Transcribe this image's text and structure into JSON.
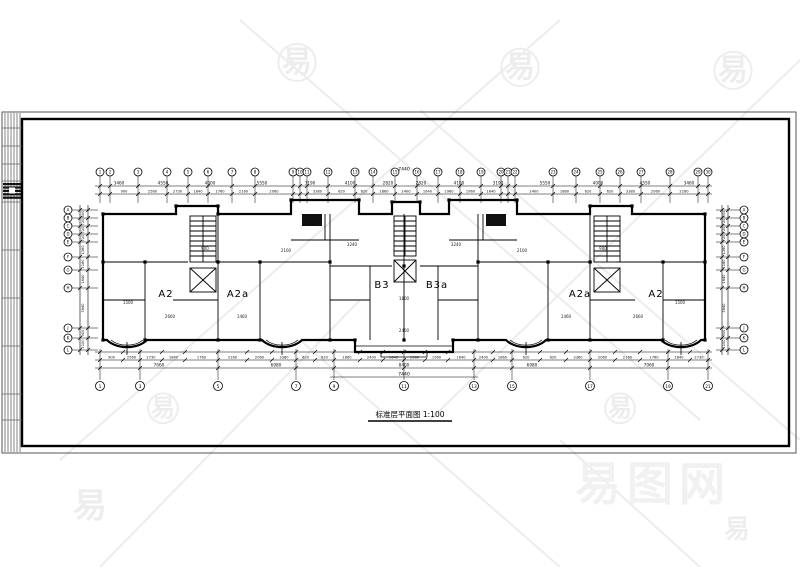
{
  "plan": {
    "title_line": "标准层平面图 1:100",
    "units": [
      {
        "label": "A2",
        "x": 166,
        "y": 297
      },
      {
        "label": "A2a",
        "x": 238,
        "y": 297
      },
      {
        "label": "B3",
        "x": 382,
        "y": 288
      },
      {
        "label": "B3a",
        "x": 437,
        "y": 288
      },
      {
        "label": "A2a",
        "x": 580,
        "y": 297
      },
      {
        "label": "A2",
        "x": 656,
        "y": 297
      }
    ],
    "annotations": [
      {
        "t": "1500",
        "x": 128,
        "y": 304
      },
      {
        "t": "2660",
        "x": 170,
        "y": 318
      },
      {
        "t": "900",
        "x": 205,
        "y": 250
      },
      {
        "t": "1460",
        "x": 242,
        "y": 318
      },
      {
        "t": "2100",
        "x": 286,
        "y": 252
      },
      {
        "t": "3240",
        "x": 352,
        "y": 246
      },
      {
        "t": "1800",
        "x": 404,
        "y": 300
      },
      {
        "t": "3240",
        "x": 456,
        "y": 246
      },
      {
        "t": "2100",
        "x": 522,
        "y": 252
      },
      {
        "t": "1460",
        "x": 566,
        "y": 318
      },
      {
        "t": "900",
        "x": 603,
        "y": 250
      },
      {
        "t": "2660",
        "x": 638,
        "y": 318
      },
      {
        "t": "1500",
        "x": 680,
        "y": 304
      },
      {
        "t": "2400",
        "x": 404,
        "y": 332
      }
    ]
  },
  "grids": {
    "top": {
      "y": 172,
      "items": [
        {
          "n": "1",
          "x": 100
        },
        {
          "n": "2",
          "x": 110
        },
        {
          "n": "3",
          "x": 138
        },
        {
          "n": "4",
          "x": 167
        },
        {
          "n": "5",
          "x": 188
        },
        {
          "n": "6",
          "x": 208
        },
        {
          "n": "7",
          "x": 232
        },
        {
          "n": "8",
          "x": 255
        },
        {
          "n": "9",
          "x": 293
        },
        {
          "n": "10",
          "x": 300
        },
        {
          "n": "11",
          "x": 307
        },
        {
          "n": "12",
          "x": 328
        },
        {
          "n": "13",
          "x": 355
        },
        {
          "n": "14",
          "x": 373
        },
        {
          "n": "15",
          "x": 395
        },
        {
          "n": "16",
          "x": 417
        },
        {
          "n": "17",
          "x": 438
        },
        {
          "n": "18",
          "x": 460
        },
        {
          "n": "19",
          "x": 481
        },
        {
          "n": "20",
          "x": 501
        },
        {
          "n": "21",
          "x": 508
        },
        {
          "n": "22",
          "x": 515
        },
        {
          "n": "23",
          "x": 553
        },
        {
          "n": "24",
          "x": 576
        },
        {
          "n": "25",
          "x": 600
        },
        {
          "n": "26",
          "x": 620
        },
        {
          "n": "27",
          "x": 641
        },
        {
          "n": "28",
          "x": 670
        },
        {
          "n": "29",
          "x": 698
        },
        {
          "n": "30",
          "x": 708
        }
      ]
    },
    "bottom": {
      "y": 386,
      "items": [
        {
          "n": "1",
          "x": 100
        },
        {
          "n": "3",
          "x": 140
        },
        {
          "n": "5",
          "x": 218
        },
        {
          "n": "7",
          "x": 296
        },
        {
          "n": "9",
          "x": 334
        },
        {
          "n": "11",
          "x": 404
        },
        {
          "n": "13",
          "x": 474
        },
        {
          "n": "15",
          "x": 512
        },
        {
          "n": "17",
          "x": 590
        },
        {
          "n": "19",
          "x": 668
        },
        {
          "n": "21",
          "x": 708
        }
      ]
    },
    "left": {
      "x": 68,
      "items": [
        {
          "n": "A",
          "y": 210
        },
        {
          "n": "B",
          "y": 218
        },
        {
          "n": "C",
          "y": 226
        },
        {
          "n": "D",
          "y": 234
        },
        {
          "n": "E",
          "y": 242
        },
        {
          "n": "F",
          "y": 257
        },
        {
          "n": "G",
          "y": 270
        },
        {
          "n": "H",
          "y": 288
        },
        {
          "n": "J",
          "y": 328
        },
        {
          "n": "K",
          "y": 338
        },
        {
          "n": "L",
          "y": 350
        }
      ]
    },
    "right": {
      "x": 744,
      "items": [
        {
          "n": "A",
          "y": 210
        },
        {
          "n": "B",
          "y": 218
        },
        {
          "n": "C",
          "y": 226
        },
        {
          "n": "D",
          "y": 234
        },
        {
          "n": "E",
          "y": 242
        },
        {
          "n": "F",
          "y": 257
        },
        {
          "n": "G",
          "y": 270
        },
        {
          "n": "H",
          "y": 288
        },
        {
          "n": "J",
          "y": 328
        },
        {
          "n": "K",
          "y": 338
        },
        {
          "n": "L",
          "y": 350
        }
      ]
    }
  },
  "dimensions": {
    "top_overall": "7440",
    "bottom_overall": "7440",
    "top_major": [
      {
        "v": "3460",
        "x": 119
      },
      {
        "v": "4550",
        "x": 163
      },
      {
        "v": "4000",
        "x": 210
      },
      {
        "v": "5550",
        "x": 262
      },
      {
        "v": "3190",
        "x": 310
      },
      {
        "v": "4100",
        "x": 350
      },
      {
        "v": "2820",
        "x": 388
      },
      {
        "v": "2820",
        "x": 421
      },
      {
        "v": "4100",
        "x": 459
      },
      {
        "v": "3190",
        "x": 498
      },
      {
        "v": "5550",
        "x": 545
      },
      {
        "v": "4000",
        "x": 598
      },
      {
        "v": "4550",
        "x": 645
      },
      {
        "v": "3460",
        "x": 689
      }
    ],
    "minor_values": [
      "900",
      "2560",
      "2730",
      "1840",
      "1760",
      "2160",
      "2060",
      "3380",
      "620",
      "620",
      "1860",
      "2400",
      "1640",
      "1960",
      "1960",
      "1640",
      "2400",
      "1860",
      "620",
      "620",
      "3380",
      "2060",
      "2160",
      "1760",
      "1840",
      "2730",
      "2560",
      "900"
    ],
    "bottom_ticks": [
      100,
      123,
      140,
      162,
      185,
      218,
      247,
      272,
      296,
      315,
      334,
      360,
      383,
      404,
      425,
      448,
      474,
      493,
      512,
      540,
      566,
      590,
      615,
      640,
      668,
      690,
      708
    ],
    "bottom_major": [
      {
        "v": "7060",
        "x": 159
      },
      {
        "v": "6980",
        "x": 276
      },
      {
        "v": "8400",
        "x": 404
      },
      {
        "v": "6980",
        "x": 532
      },
      {
        "v": "7060",
        "x": 649
      }
    ],
    "left_vert": [
      {
        "v": "500",
        "y": 214
      },
      {
        "v": "720",
        "y": 222
      },
      {
        "v": "720",
        "y": 230
      },
      {
        "v": "720",
        "y": 238
      },
      {
        "v": "1360",
        "y": 250
      },
      {
        "v": "1180",
        "y": 264
      },
      {
        "v": "1640",
        "y": 279
      },
      {
        "v": "3640",
        "y": 308
      },
      {
        "v": "900",
        "y": 333
      },
      {
        "v": "1100",
        "y": 344
      }
    ]
  },
  "watermarks": {
    "glyph": "易",
    "site": {
      "text": "易图网",
      "x": 575,
      "y": 500,
      "size": 46
    },
    "positions": [
      {
        "x": 297,
        "y": 72,
        "s": 30,
        "circle": true
      },
      {
        "x": 520,
        "y": 77,
        "s": 30,
        "circle": true
      },
      {
        "x": 733,
        "y": 80,
        "s": 30,
        "circle": true
      },
      {
        "x": 163,
        "y": 416,
        "s": 24,
        "circle": true
      },
      {
        "x": 620,
        "y": 416,
        "s": 24,
        "circle": true
      },
      {
        "x": 90,
        "y": 517,
        "s": 34,
        "circle": false
      },
      {
        "x": 737,
        "y": 538,
        "s": 26,
        "circle": false
      }
    ],
    "color": "#ededed"
  }
}
